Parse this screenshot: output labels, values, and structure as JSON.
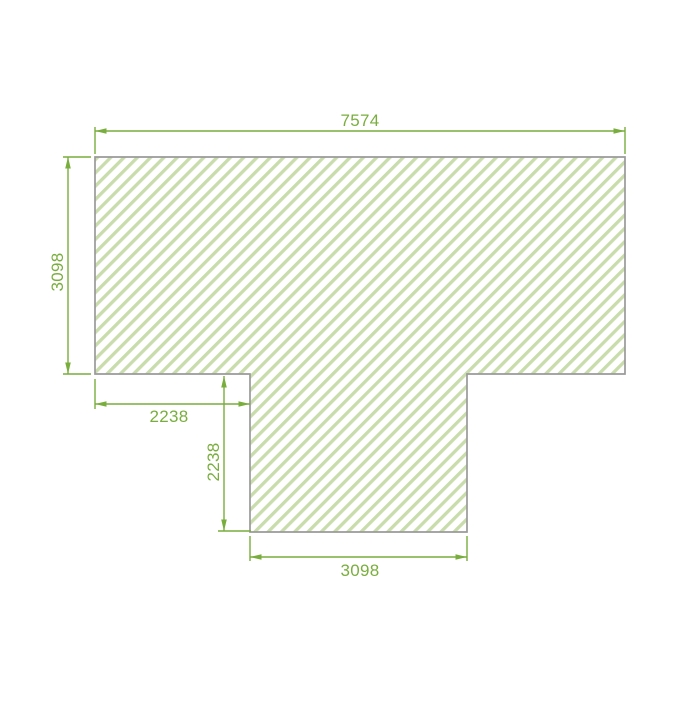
{
  "drawing": {
    "description": "T-shaped hatched profile with dimension annotations",
    "colors": {
      "dim": "#79ae3d",
      "hatch": "#c9dcab",
      "outline": "#9a9a9a",
      "background": "#ffffff"
    },
    "dimensions": {
      "top_width": "7574",
      "left_height": "3098",
      "notch_width": "2238",
      "notch_height": "2238",
      "bottom_width": "3098"
    }
  }
}
